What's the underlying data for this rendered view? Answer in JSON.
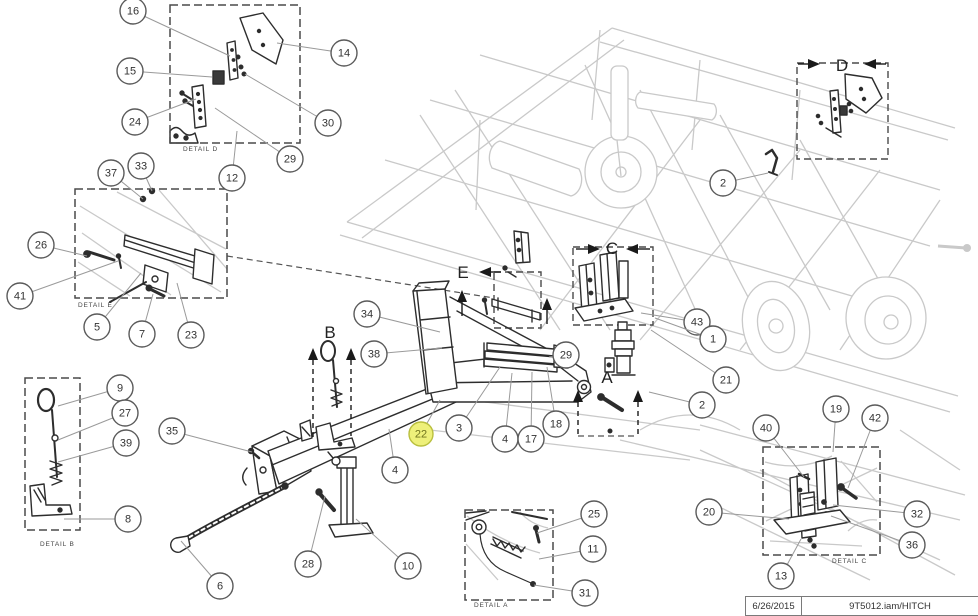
{
  "title_block": {
    "date": "6/26/2015",
    "document": "9T5012.iam/HITCH"
  },
  "highlighted_part": "22",
  "colors": {
    "line": "#2d2d2d",
    "leader": "#9a9a9a",
    "background_machine": "#c9c9c9",
    "callout_stroke": "#5a5a5a",
    "callout_text": "#333333",
    "highlight_fill": "#eef07a",
    "highlight_stroke": "#b9bf3e",
    "highlight_text": "#70741d",
    "dashed_box": "#4a4a4a"
  },
  "detail_views": [
    {
      "id": "D",
      "label": "DETAIL D",
      "box": {
        "x": 170,
        "y": 5,
        "w": 130,
        "h": 138
      },
      "label_pos": {
        "x": 183,
        "y": 151
      }
    },
    {
      "id": "E",
      "label": "DETAIL E",
      "box": {
        "x": 75,
        "y": 189,
        "w": 152,
        "h": 109
      },
      "label_pos": {
        "x": 78,
        "y": 307
      }
    },
    {
      "id": "B",
      "label": "DETAIL B",
      "box": {
        "x": 25,
        "y": 378,
        "w": 55,
        "h": 152
      },
      "label_pos": {
        "x": 40,
        "y": 546
      }
    },
    {
      "id": "A",
      "label": "DETAIL A",
      "box": {
        "x": 465,
        "y": 510,
        "w": 88,
        "h": 90
      },
      "label_pos": {
        "x": 474,
        "y": 607
      }
    },
    {
      "id": "C",
      "label": "DETAIL C",
      "box": {
        "x": 763,
        "y": 447,
        "w": 117,
        "h": 108
      },
      "label_pos": {
        "x": 832,
        "y": 563
      }
    }
  ],
  "source_boxes": [
    {
      "letter": "D",
      "x": 797,
      "y": 63,
      "w": 91,
      "h": 96
    },
    {
      "letter": "C",
      "x": 573,
      "y": 247,
      "w": 80,
      "h": 78
    },
    {
      "letter": "E",
      "x": 494,
      "y": 272,
      "w": 47,
      "h": 56
    }
  ],
  "view_letters": [
    {
      "letter": "B",
      "x": 330,
      "y": 338
    },
    {
      "letter": "E",
      "x": 463,
      "y": 278
    },
    {
      "letter": "A",
      "x": 607,
      "y": 383
    },
    {
      "letter": "C",
      "x": 612,
      "y": 254
    },
    {
      "letter": "D",
      "x": 842,
      "y": 71
    }
  ],
  "pointer_arrows": [
    {
      "dir": "right",
      "x": 820,
      "y": 64,
      "stem": 10,
      "dashed": false
    },
    {
      "dir": "left",
      "x": 864,
      "y": 64,
      "stem": 10,
      "dashed": false
    },
    {
      "dir": "right",
      "x": 600,
      "y": 249,
      "stem": 12,
      "dashed": false
    },
    {
      "dir": "left",
      "x": 626,
      "y": 249,
      "stem": 12,
      "dashed": false
    },
    {
      "dir": "left",
      "x": 479,
      "y": 272,
      "stem": 10,
      "dashed": false
    },
    {
      "dir": "up",
      "x": 313,
      "y": 348,
      "stem": 78,
      "dashed": true
    },
    {
      "dir": "up",
      "x": 351,
      "y": 348,
      "stem": 76,
      "dashed": true
    },
    {
      "dir": "up",
      "x": 578,
      "y": 390,
      "stem": 34,
      "dashed": true
    },
    {
      "dir": "up",
      "x": 638,
      "y": 390,
      "stem": 34,
      "dashed": true
    },
    {
      "dir": "up",
      "x": 462,
      "y": 290,
      "stem": 14,
      "dashed": false
    },
    {
      "dir": "up",
      "x": 547,
      "y": 298,
      "stem": 14,
      "dashed": false
    }
  ],
  "extra_dashed_lines": [
    [
      578,
      436,
      638,
      436
    ],
    [
      227,
      256,
      494,
      298
    ]
  ],
  "callouts": [
    {
      "n": "16",
      "cx": 133,
      "cy": 11,
      "tx": 230,
      "ty": 56
    },
    {
      "n": "14",
      "cx": 344,
      "cy": 53,
      "tx": 277,
      "ty": 43
    },
    {
      "n": "15",
      "cx": 130,
      "cy": 71,
      "tx": 212,
      "ty": 77
    },
    {
      "n": "24",
      "cx": 135,
      "cy": 122,
      "tx": 196,
      "ty": 99
    },
    {
      "n": "30",
      "cx": 328,
      "cy": 123,
      "tx": 245,
      "ty": 74
    },
    {
      "n": "29",
      "cx": 290,
      "cy": 159,
      "tx": 215,
      "ty": 108
    },
    {
      "n": "12",
      "cx": 232,
      "cy": 178,
      "tx": 237,
      "ty": 131
    },
    {
      "n": "33",
      "cx": 141,
      "cy": 166,
      "tx": 152,
      "ty": 191
    },
    {
      "n": "37",
      "cx": 111,
      "cy": 173,
      "tx": 143,
      "ty": 199
    },
    {
      "n": "26",
      "cx": 41,
      "cy": 245,
      "tx": 87,
      "ty": 256
    },
    {
      "n": "41",
      "cx": 20,
      "cy": 296,
      "tx": 118,
      "ty": 261
    },
    {
      "n": "5",
      "cx": 97,
      "cy": 327,
      "tx": 141,
      "ty": 273
    },
    {
      "n": "7",
      "cx": 142,
      "cy": 334,
      "tx": 153,
      "ty": 294
    },
    {
      "n": "23",
      "cx": 191,
      "cy": 335,
      "tx": 177,
      "ty": 283
    },
    {
      "n": "9",
      "cx": 120,
      "cy": 388,
      "tx": 58,
      "ty": 406
    },
    {
      "n": "27",
      "cx": 125,
      "cy": 413,
      "tx": 58,
      "ty": 440
    },
    {
      "n": "39",
      "cx": 126,
      "cy": 443,
      "tx": 58,
      "ty": 462
    },
    {
      "n": "8",
      "cx": 128,
      "cy": 519,
      "tx": 64,
      "ty": 519
    },
    {
      "n": "35",
      "cx": 172,
      "cy": 431,
      "tx": 252,
      "ty": 452
    },
    {
      "n": "6",
      "cx": 220,
      "cy": 586,
      "tx": 181,
      "ty": 541
    },
    {
      "n": "28",
      "cx": 308,
      "cy": 564,
      "tx": 325,
      "ty": 496
    },
    {
      "n": "10",
      "cx": 408,
      "cy": 566,
      "tx": 356,
      "ty": 519
    },
    {
      "n": "34",
      "cx": 367,
      "cy": 314,
      "tx": 440,
      "ty": 332
    },
    {
      "n": "38",
      "cx": 374,
      "cy": 354,
      "tx": 442,
      "ty": 348
    },
    {
      "n": "3",
      "cx": 459,
      "cy": 428,
      "tx": 500,
      "ty": 367
    },
    {
      "n": "4",
      "cx": 395,
      "cy": 470,
      "tx": 389,
      "ty": 429
    },
    {
      "n": "22",
      "cx": 421,
      "cy": 434,
      "tx": 440,
      "ty": 400,
      "highlight": true
    },
    {
      "n": "4",
      "cx": 505,
      "cy": 439,
      "tx": 512,
      "ty": 373
    },
    {
      "n": "17",
      "cx": 531,
      "cy": 439,
      "tx": 532,
      "ty": 372
    },
    {
      "n": "18",
      "cx": 556,
      "cy": 424,
      "tx": 547,
      "ty": 367
    },
    {
      "n": "29",
      "cx": 566,
      "cy": 355,
      "tx": 549,
      "ty": 357
    },
    {
      "n": "43",
      "cx": 697,
      "cy": 322,
      "tx": 641,
      "ty": 313
    },
    {
      "n": "1",
      "cx": 713,
      "cy": 339,
      "tx": 655,
      "ty": 318
    },
    {
      "n": "21",
      "cx": 726,
      "cy": 380,
      "tx": 651,
      "ty": 330
    },
    {
      "n": "2",
      "cx": 723,
      "cy": 183,
      "tx": 768,
      "ty": 173
    },
    {
      "n": "2",
      "cx": 702,
      "cy": 405,
      "tx": 649,
      "ty": 392
    },
    {
      "n": "19",
      "cx": 836,
      "cy": 409,
      "tx": 833,
      "ty": 452
    },
    {
      "n": "42",
      "cx": 875,
      "cy": 418,
      "tx": 848,
      "ty": 488
    },
    {
      "n": "40",
      "cx": 766,
      "cy": 428,
      "tx": 804,
      "ty": 477
    },
    {
      "n": "20",
      "cx": 709,
      "cy": 512,
      "tx": 789,
      "ty": 519
    },
    {
      "n": "32",
      "cx": 917,
      "cy": 514,
      "tx": 833,
      "ty": 505
    },
    {
      "n": "36",
      "cx": 912,
      "cy": 545,
      "tx": 831,
      "ty": 516
    },
    {
      "n": "13",
      "cx": 781,
      "cy": 576,
      "tx": 801,
      "ty": 539
    },
    {
      "n": "25",
      "cx": 594,
      "cy": 514,
      "tx": 537,
      "ty": 533
    },
    {
      "n": "11",
      "cx": 593,
      "cy": 549,
      "tx": 539,
      "ty": 559
    },
    {
      "n": "31",
      "cx": 585,
      "cy": 593,
      "tx": 534,
      "ty": 585
    }
  ]
}
